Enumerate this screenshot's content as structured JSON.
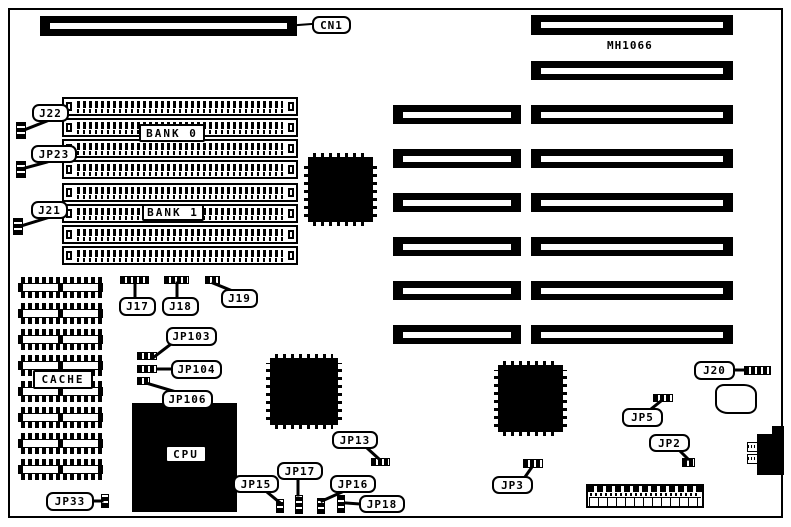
{
  "board": {
    "model": "MH1066"
  },
  "labels": {
    "cn1": "CN1",
    "mh1066": "MH1066",
    "j22": "J22",
    "jp23": "JP23",
    "j21": "J21",
    "bank0": "BANK 0",
    "bank1": "BANK 1",
    "cache": "CACHE",
    "cpu": "CPU",
    "j17": "J17",
    "j18": "J18",
    "j19": "J19",
    "jp103": "JP103",
    "jp104": "JP104",
    "jp106": "JP106",
    "jp33": "JP33",
    "jp15": "JP15",
    "jp17": "JP17",
    "jp16": "JP16",
    "jp18": "JP18",
    "jp13": "JP13",
    "jp3": "JP3",
    "jp5": "JP5",
    "jp2": "JP2",
    "j20": "J20"
  },
  "colors": {
    "ink": "#000000",
    "paper": "#ffffff"
  }
}
